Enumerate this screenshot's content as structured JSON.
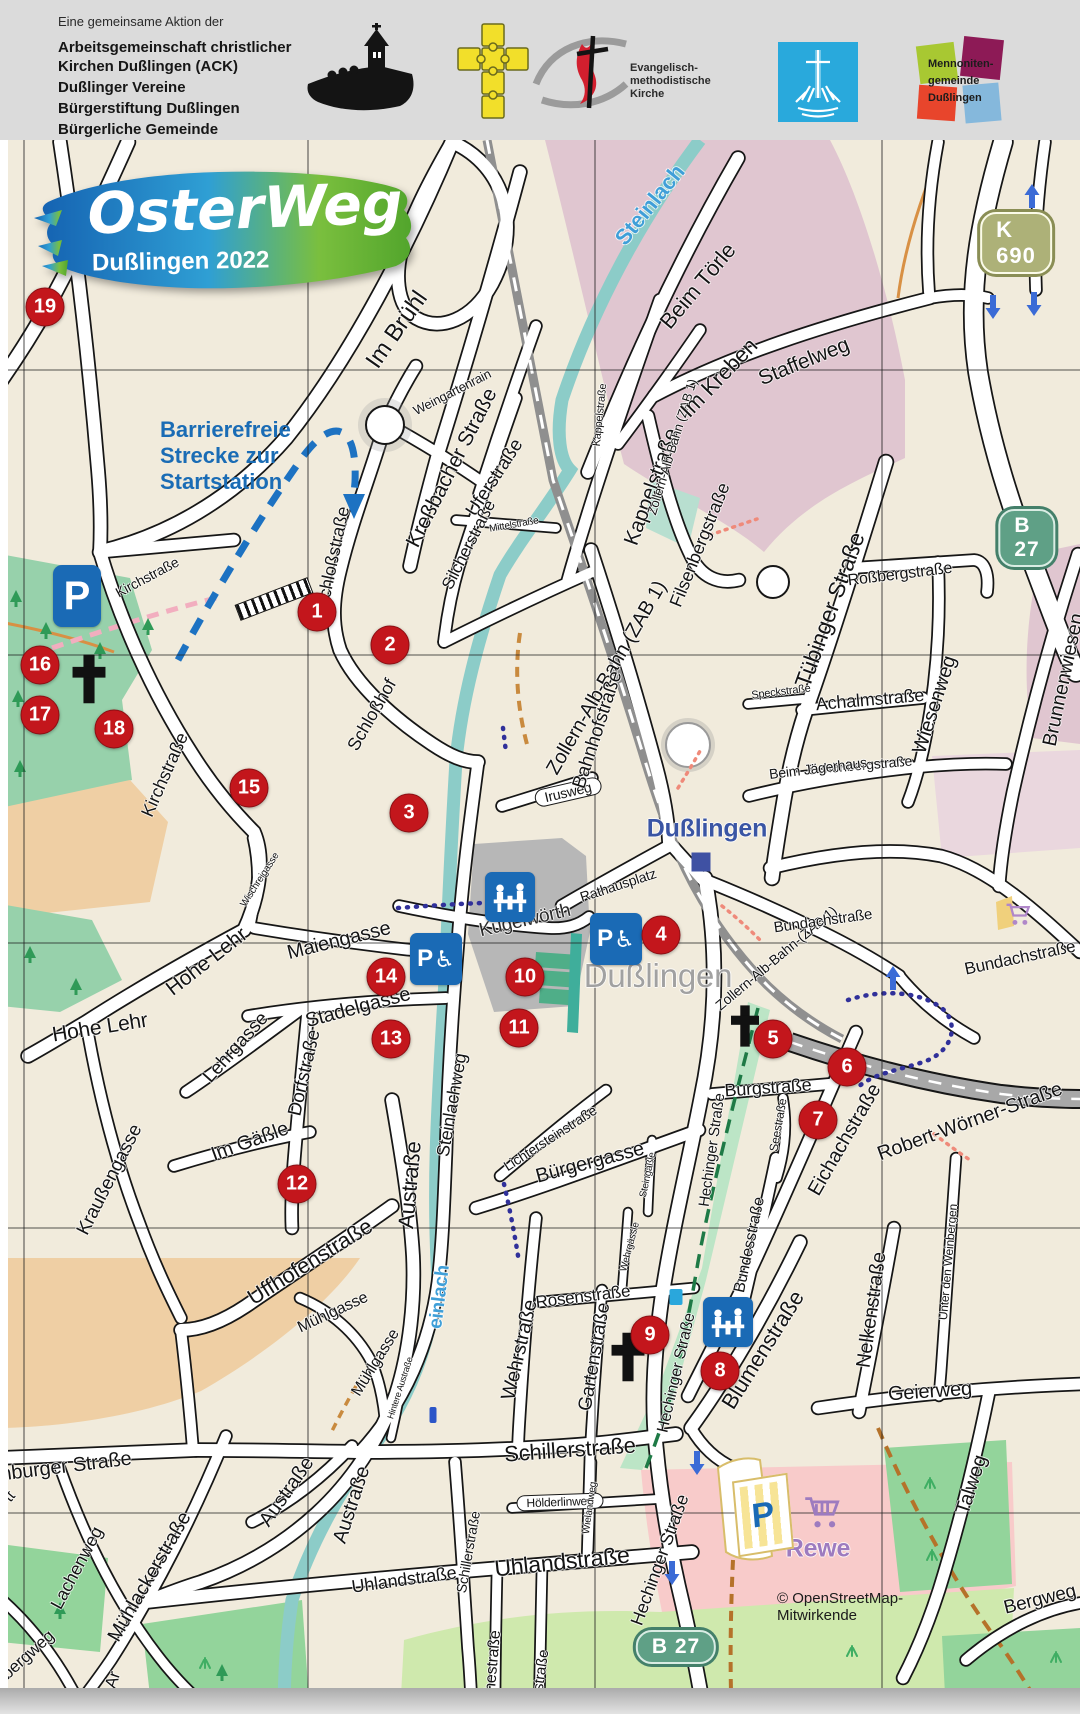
{
  "header": {
    "intro": "Eine gemeinsame Aktion der",
    "organizations": [
      "Arbeitsgemeinschaft christlicher Kirchen Dußlingen (ACK)",
      "Dußlinger Vereine",
      "Bürgerstiftung Dußlingen",
      "Bürgerliche Gemeinde"
    ],
    "emk_lines": [
      "Evangelisch-",
      "methodistische",
      "Kirche"
    ],
    "mennoniten_lines": [
      "Mennoniten-",
      "gemeinde",
      "Dußlingen"
    ]
  },
  "map": {
    "logo": {
      "title": "OsterWeg",
      "subtitle": "Dußlingen 2022"
    },
    "note": [
      "Barrierefreie",
      "Strecke zur",
      "Startstation"
    ],
    "attribution": "© OpenStreetMap-Mitwirkende",
    "colors": {
      "marker_red": "#c3161c",
      "icon_blue": "#1a6ab5",
      "route_blue": "#30309a",
      "barrier_blue": "#1d72c2",
      "water_label_blue": "#3f9fd8",
      "k_badge": "#adb178",
      "b_badge": "#5fa086"
    },
    "road_badges": [
      {
        "text": "K 690",
        "x": 1016,
        "y": 243,
        "style": "k"
      },
      {
        "text": "B 27",
        "x": 1027,
        "y": 538,
        "style": "b"
      },
      {
        "text": "B 27",
        "x": 676,
        "y": 1647,
        "style": "b"
      }
    ],
    "station_markers": [
      {
        "n": "1",
        "x": 317,
        "y": 612
      },
      {
        "n": "2",
        "x": 390,
        "y": 645
      },
      {
        "n": "3",
        "x": 409,
        "y": 813
      },
      {
        "n": "4",
        "x": 661,
        "y": 935
      },
      {
        "n": "5",
        "x": 773,
        "y": 1039
      },
      {
        "n": "6",
        "x": 847,
        "y": 1067
      },
      {
        "n": "7",
        "x": 818,
        "y": 1120
      },
      {
        "n": "8",
        "x": 720,
        "y": 1371
      },
      {
        "n": "9",
        "x": 650,
        "y": 1335
      },
      {
        "n": "10",
        "x": 525,
        "y": 977
      },
      {
        "n": "11",
        "x": 519,
        "y": 1028
      },
      {
        "n": "12",
        "x": 297,
        "y": 1184
      },
      {
        "n": "13",
        "x": 391,
        "y": 1039
      },
      {
        "n": "14",
        "x": 386,
        "y": 977
      },
      {
        "n": "15",
        "x": 249,
        "y": 788
      },
      {
        "n": "16",
        "x": 40,
        "y": 665
      },
      {
        "n": "17",
        "x": 40,
        "y": 715
      },
      {
        "n": "18",
        "x": 114,
        "y": 729
      },
      {
        "n": "19",
        "x": 45,
        "y": 307
      }
    ],
    "place_labels": [
      {
        "t": "Dußlingen",
        "x": 707,
        "y": 829,
        "r": 0,
        "s": 25,
        "c": "#3a55a4",
        "w": 700,
        "name": "station-name-label"
      },
      {
        "t": "Dußlingen",
        "x": 658,
        "y": 976,
        "r": 0,
        "s": 33,
        "c": "#a1a1a1",
        "w": 400,
        "name": "town-name-label"
      },
      {
        "t": "Rewe",
        "x": 818,
        "y": 1549,
        "r": 0,
        "s": 25,
        "c": "#9d7bbf",
        "w": 700,
        "name": "supermarket-label"
      }
    ],
    "street_labels": [
      {
        "t": "Im Brühl",
        "x": 397,
        "y": 330,
        "r": -55,
        "s": 24
      },
      {
        "t": "Weingartenrain",
        "x": 452,
        "y": 392,
        "r": -27,
        "s": 13
      },
      {
        "t": "Kreßbacher Straße",
        "x": 452,
        "y": 468,
        "r": -63,
        "s": 21
      },
      {
        "t": "Uferstraße",
        "x": 495,
        "y": 478,
        "r": -57,
        "s": 19
      },
      {
        "t": "Silcherstraße",
        "x": 469,
        "y": 545,
        "r": -63,
        "s": 17
      },
      {
        "t": "Mittelstraße",
        "x": 514,
        "y": 525,
        "r": -10,
        "s": 10
      },
      {
        "t": "Kappelstraße",
        "x": 600,
        "y": 415,
        "r": -84,
        "s": 11
      },
      {
        "t": "Kappelstraße",
        "x": 652,
        "y": 487,
        "r": -70,
        "s": 21
      },
      {
        "t": "Zollern-Alb-Bahn (ZAB 1)",
        "x": 672,
        "y": 447,
        "r": -73,
        "s": 13
      },
      {
        "t": "Zollern-Alb-Bahn (ZAB 1)",
        "x": 607,
        "y": 678,
        "r": -60,
        "s": 20
      },
      {
        "t": "Zollern-Alb-Bahn-(ZAB 1)",
        "x": 776,
        "y": 958,
        "r": -40,
        "s": 14
      },
      {
        "t": "Steinlach",
        "x": 650,
        "y": 205,
        "r": -51,
        "s": 22,
        "c": "#3f9fd8",
        "w": 700
      },
      {
        "t": "einlach",
        "x": 440,
        "y": 1297,
        "r": -83,
        "s": 19,
        "c": "#3f9fd8",
        "w": 700
      },
      {
        "t": "Beim Törle",
        "x": 698,
        "y": 286,
        "r": -50,
        "s": 22
      },
      {
        "t": "Im Kreben",
        "x": 719,
        "y": 378,
        "r": -46,
        "s": 22
      },
      {
        "t": "Staffelweg",
        "x": 804,
        "y": 362,
        "r": -22,
        "s": 21
      },
      {
        "t": "Filsenbergstraße",
        "x": 700,
        "y": 545,
        "r": -68,
        "s": 18
      },
      {
        "t": "Tübinger Straße",
        "x": 830,
        "y": 610,
        "r": -70,
        "s": 23
      },
      {
        "t": "Roßbergstraße",
        "x": 900,
        "y": 575,
        "r": -7,
        "s": 16
      },
      {
        "t": "Speckstraße",
        "x": 781,
        "y": 692,
        "r": -7,
        "s": 11
      },
      {
        "t": "Achalmstraße",
        "x": 870,
        "y": 700,
        "r": -5,
        "s": 18
      },
      {
        "t": "Schönbergstraße",
        "x": 860,
        "y": 765,
        "r": -5,
        "s": 14
      },
      {
        "t": "Wiesenweg",
        "x": 935,
        "y": 705,
        "r": -72,
        "s": 20
      },
      {
        "t": "Brunnenwiesen",
        "x": 1064,
        "y": 680,
        "r": -78,
        "s": 20
      },
      {
        "t": "Beim Jägerhaus",
        "x": 818,
        "y": 768,
        "r": -7,
        "s": 14
      },
      {
        "t": "Bundachstraße",
        "x": 823,
        "y": 921,
        "r": -8,
        "s": 15
      },
      {
        "t": "Bundachstraße",
        "x": 1020,
        "y": 958,
        "r": -12,
        "s": 17
      },
      {
        "t": "Irusweg",
        "x": 568,
        "y": 792,
        "r": -13,
        "s": 14,
        "pill": true
      },
      {
        "t": "Bahnhofstraße",
        "x": 598,
        "y": 730,
        "r": -72,
        "s": 19
      },
      {
        "t": "Rathausplatz",
        "x": 618,
        "y": 885,
        "r": -18,
        "s": 14
      },
      {
        "t": "Kugelwörth",
        "x": 525,
        "y": 921,
        "r": -13,
        "s": 19,
        "c": "#2b2b2b"
      },
      {
        "t": "Kirchstraße",
        "x": 147,
        "y": 577,
        "r": -28,
        "s": 14
      },
      {
        "t": "Kirchstraße",
        "x": 165,
        "y": 775,
        "r": -66,
        "s": 18
      },
      {
        "t": "Schloßstraße",
        "x": 333,
        "y": 558,
        "r": -78,
        "s": 18
      },
      {
        "t": "Schloßhof",
        "x": 372,
        "y": 715,
        "r": -60,
        "s": 18
      },
      {
        "t": "Wischreigasse",
        "x": 260,
        "y": 880,
        "r": -57,
        "s": 10
      },
      {
        "t": "Maiengasse",
        "x": 339,
        "y": 941,
        "r": -14,
        "s": 20
      },
      {
        "t": "Stadelgasse",
        "x": 358,
        "y": 1008,
        "r": -15,
        "s": 20
      },
      {
        "t": "Hohe Lehr",
        "x": 207,
        "y": 962,
        "r": -38,
        "s": 21
      },
      {
        "t": "Hohe Lehr",
        "x": 100,
        "y": 1028,
        "r": -9,
        "s": 21
      },
      {
        "t": "Lehrgasse",
        "x": 236,
        "y": 1048,
        "r": -48,
        "s": 19
      },
      {
        "t": "Dorfstraße",
        "x": 305,
        "y": 1073,
        "r": -77,
        "s": 19
      },
      {
        "t": "Im Gäßle",
        "x": 250,
        "y": 1142,
        "r": -20,
        "s": 20
      },
      {
        "t": "Kraußengasse",
        "x": 110,
        "y": 1180,
        "r": -63,
        "s": 19
      },
      {
        "t": "Steinlachweg",
        "x": 452,
        "y": 1105,
        "r": -80,
        "s": 18
      },
      {
        "t": "Lichtersteinstraße",
        "x": 550,
        "y": 1138,
        "r": -33,
        "s": 14
      },
      {
        "t": "Bürgergasse",
        "x": 590,
        "y": 1163,
        "r": -15,
        "s": 20
      },
      {
        "t": "Steingäßle",
        "x": 648,
        "y": 1175,
        "r": -78,
        "s": 10
      },
      {
        "t": "Hechinger Straße",
        "x": 712,
        "y": 1150,
        "r": -82,
        "s": 15
      },
      {
        "t": "Wehrgässle",
        "x": 630,
        "y": 1247,
        "r": -75,
        "s": 10
      },
      {
        "t": "Burgstraße",
        "x": 768,
        "y": 1088,
        "r": -4,
        "s": 18
      },
      {
        "t": "Seestraße",
        "x": 778,
        "y": 1125,
        "r": -80,
        "s": 12
      },
      {
        "t": "Eichachstraße",
        "x": 845,
        "y": 1140,
        "r": -60,
        "s": 20
      },
      {
        "t": "Robert-Wörner-Straße",
        "x": 970,
        "y": 1122,
        "r": -20,
        "s": 20
      },
      {
        "t": "Rosenstraße",
        "x": 583,
        "y": 1297,
        "r": -7,
        "s": 17
      },
      {
        "t": "Wehrstraße",
        "x": 520,
        "y": 1350,
        "r": -77,
        "s": 20
      },
      {
        "t": "Gartenstraße",
        "x": 595,
        "y": 1357,
        "r": -80,
        "s": 19
      },
      {
        "t": "Hechinger Straße",
        "x": 677,
        "y": 1373,
        "r": -77,
        "s": 16
      },
      {
        "t": "Bundesstraße",
        "x": 750,
        "y": 1245,
        "r": -78,
        "s": 16
      },
      {
        "t": "Blumenstraße",
        "x": 763,
        "y": 1350,
        "r": -58,
        "s": 22
      },
      {
        "t": "Nelkenstraße",
        "x": 872,
        "y": 1310,
        "r": -82,
        "s": 20
      },
      {
        "t": "Unter den Weinbergen",
        "x": 948,
        "y": 1262,
        "r": -85,
        "s": 12
      },
      {
        "t": "Geierweg",
        "x": 930,
        "y": 1392,
        "r": -4,
        "s": 20
      },
      {
        "t": "Talweg",
        "x": 972,
        "y": 1485,
        "r": -72,
        "s": 20
      },
      {
        "t": "Bergweg",
        "x": 1040,
        "y": 1600,
        "r": -14,
        "s": 19
      },
      {
        "t": "Hölderlinweg",
        "x": 560,
        "y": 1502,
        "r": -2,
        "s": 12,
        "pill": true
      },
      {
        "t": "Wielandweg",
        "x": 590,
        "y": 1508,
        "r": -82,
        "s": 10
      },
      {
        "t": "Schillerstraße",
        "x": 570,
        "y": 1450,
        "r": -4,
        "s": 22
      },
      {
        "t": "Schillerstraße",
        "x": 468,
        "y": 1552,
        "r": -80,
        "s": 14
      },
      {
        "t": "Uhlandstraße",
        "x": 404,
        "y": 1580,
        "r": -8,
        "s": 18
      },
      {
        "t": "Uhlandstraße",
        "x": 562,
        "y": 1562,
        "r": -6,
        "s": 23
      },
      {
        "t": "Goethestraße",
        "x": 492,
        "y": 1678,
        "r": -85,
        "s": 16
      },
      {
        "t": "Mörikestraße",
        "x": 538,
        "y": 1692,
        "r": -82,
        "s": 15
      },
      {
        "t": "Hechinger Straße",
        "x": 660,
        "y": 1560,
        "r": -70,
        "s": 18
      },
      {
        "t": "Mühlgasse",
        "x": 333,
        "y": 1313,
        "r": -25,
        "s": 16
      },
      {
        "t": "Mühlgasse",
        "x": 376,
        "y": 1363,
        "r": -58,
        "s": 16
      },
      {
        "t": "Hintere Austraße",
        "x": 400,
        "y": 1388,
        "r": -72,
        "s": 9
      },
      {
        "t": "Austraße",
        "x": 410,
        "y": 1185,
        "r": -85,
        "s": 22
      },
      {
        "t": "Austraße",
        "x": 287,
        "y": 1492,
        "r": -55,
        "s": 20
      },
      {
        "t": "Austraße",
        "x": 352,
        "y": 1505,
        "r": -72,
        "s": 20
      },
      {
        "t": "Uffhofenstraße",
        "x": 310,
        "y": 1262,
        "r": -32,
        "s": 22
      },
      {
        "t": "nburger Straße",
        "x": 66,
        "y": 1467,
        "r": -7,
        "s": 20
      },
      {
        "t": "tt",
        "x": 10,
        "y": 1497,
        "r": -50,
        "s": 16
      },
      {
        "t": "Lachenweg",
        "x": 77,
        "y": 1568,
        "r": -62,
        "s": 18
      },
      {
        "t": "Mühlackerstraße",
        "x": 150,
        "y": 1577,
        "r": -60,
        "s": 20
      },
      {
        "t": "bergweg",
        "x": 28,
        "y": 1655,
        "r": -42,
        "s": 17
      },
      {
        "t": "Ar",
        "x": 113,
        "y": 1680,
        "r": -72,
        "s": 17
      }
    ],
    "icons": [
      {
        "type": "parking",
        "x": 77,
        "y": 596
      },
      {
        "type": "parking-disabled",
        "x": 436,
        "y": 959
      },
      {
        "type": "parking-disabled",
        "x": 616,
        "y": 939
      },
      {
        "type": "picnic",
        "x": 510,
        "y": 897
      },
      {
        "type": "picnic",
        "x": 728,
        "y": 1322
      },
      {
        "type": "church-cross",
        "x": 89,
        "y": 679,
        "s": 40
      },
      {
        "type": "church-cross",
        "x": 745,
        "y": 1026,
        "s": 34
      },
      {
        "type": "church-cross",
        "x": 628,
        "y": 1357,
        "s": 40
      },
      {
        "type": "station-square",
        "x": 701,
        "y": 862
      },
      {
        "type": "bus-stop",
        "x": 676,
        "y": 1297
      },
      {
        "type": "stop-bar",
        "x": 433,
        "y": 1415
      },
      {
        "type": "steps",
        "x": 274,
        "y": 599
      },
      {
        "type": "rewe-parking",
        "x": 763,
        "y": 1515
      },
      {
        "type": "shopping-cart",
        "x": 822,
        "y": 1512
      },
      {
        "type": "shopping-cart-small",
        "x": 1018,
        "y": 914
      }
    ],
    "arrows": [
      {
        "x": 1032,
        "y": 196,
        "r": 0
      },
      {
        "x": 993,
        "y": 307,
        "r": 180
      },
      {
        "x": 1034,
        "y": 304,
        "r": 180
      },
      {
        "x": 893,
        "y": 978,
        "r": 0
      },
      {
        "x": 697,
        "y": 1463,
        "r": 180
      },
      {
        "x": 672,
        "y": 1573,
        "r": 180
      }
    ]
  }
}
